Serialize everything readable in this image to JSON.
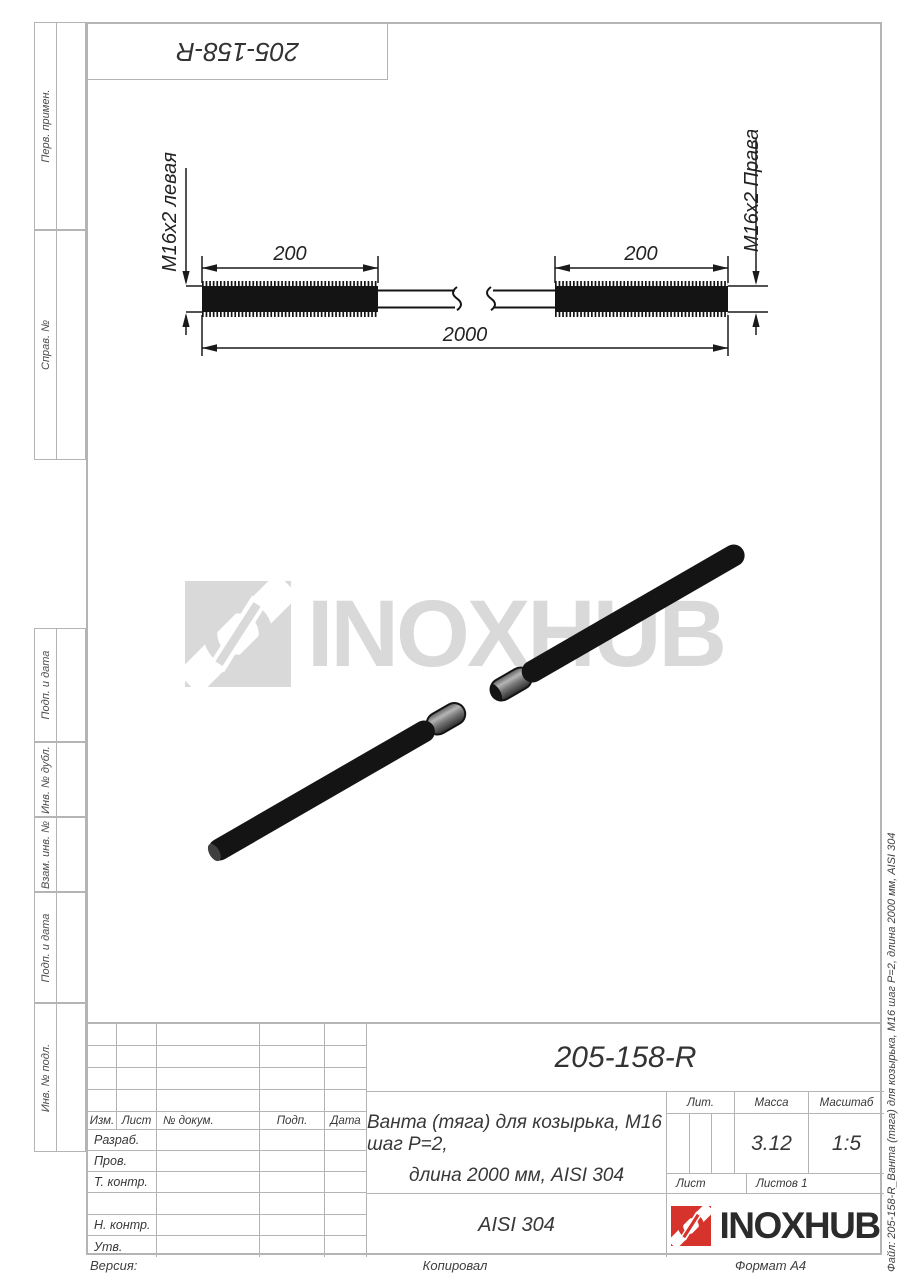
{
  "colors": {
    "line": "#b4b4b4",
    "watermark_gray": "#d9d9d9",
    "brand_red": "#d6332c"
  },
  "sheet": {
    "top_stamp": "205-158-R",
    "margin_labels": [
      "Перв. примен.",
      "Справ. №",
      "Подп. и дата",
      "Инв. № дубл.",
      "Взам. инв. №",
      "Подп. и дата",
      "Инв. № подл."
    ],
    "file_label": "Файл: 205-158-R_Ванта (тяга) для козырька, М16 шаг Р=2, длина 2000 мм, AISI 304",
    "footer": {
      "left": "Версия:",
      "center": "Копировал",
      "right": "Формат А4"
    }
  },
  "drawing": {
    "dim_left_thread": "200",
    "dim_right_thread": "200",
    "dim_total": "2000",
    "thread_left_label": "M16x2 левая",
    "thread_right_label": "M16x2 Правая"
  },
  "watermark": {
    "brand": "INOXHUB"
  },
  "title_block": {
    "designation": "205-158-R",
    "description_line1": "Ванта (тяга) для козырька, М16 шаг Р=2,",
    "description_line2": "длина 2000 мм, AISI 304",
    "material": "AISI 304",
    "col_headers": {
      "izm": "Изм.",
      "list": "Лист",
      "dokum": "№ докум.",
      "podp": "Подп.",
      "data": "Дата"
    },
    "row_labels": [
      "Разраб.",
      "Пров.",
      "Т. контр.",
      "",
      "Н. контр.",
      "Утв."
    ],
    "lit_header": "Лит.",
    "mass_header": "Масса",
    "scale_header": "Масштаб",
    "mass_value": "3.12",
    "scale_value": "1:5",
    "sheet_label": "Лист",
    "sheets_label": "Листов 1",
    "brand": "INOXHUB"
  }
}
